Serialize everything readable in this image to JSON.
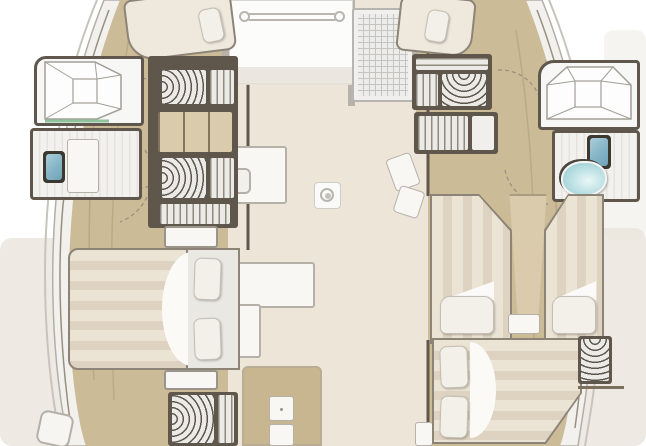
{
  "floorplan": {
    "vessel": "catamaran yacht interior deck plan (top-down)",
    "areas": [
      "port-hull",
      "starboard-hull",
      "saloon",
      "bow-berth",
      "forward-hatch",
      "port-forward-cabin",
      "port-wardrobes",
      "port-shower-room",
      "port-head",
      "owner-cabin",
      "owner-aft-wardrobe",
      "starboard-forward-cabin",
      "starboard-wardrobes",
      "starboard-shower-room",
      "starboard-head",
      "starboard-twin-beds",
      "starboard-aft-cabin",
      "galley",
      "nav-seats",
      "ceiling-light",
      "saloon-table"
    ]
  },
  "colors": {
    "page_bg": "#ffffff",
    "ambient": "#e8e3da",
    "deck": "#f2f1ee",
    "hull_edge": "#c8c4bc",
    "wood": "#ccbb97",
    "wood_light": "#d9cbab",
    "wall": "#5f574c",
    "saloon": "#ece5d8",
    "white_furniture": "#f8f7f4",
    "furniture_border": "#b5b1a9",
    "frame": "#8d8478",
    "duvet": "#ebe3d4",
    "duvet_stripe": "#ded3c0",
    "pillow": "#f3f0e9",
    "hanger_bg": "#ebeae7",
    "hanger_line": "#5c564c",
    "stripe_line": "#8f897e",
    "toilet_blue": "#85b4c6",
    "sink_teal": "#bfe2e5",
    "glass_green": "#8fc39b",
    "table_wood": "#c8b691",
    "hatch_line": "#c6c4bf",
    "arc": "#9b9181"
  }
}
